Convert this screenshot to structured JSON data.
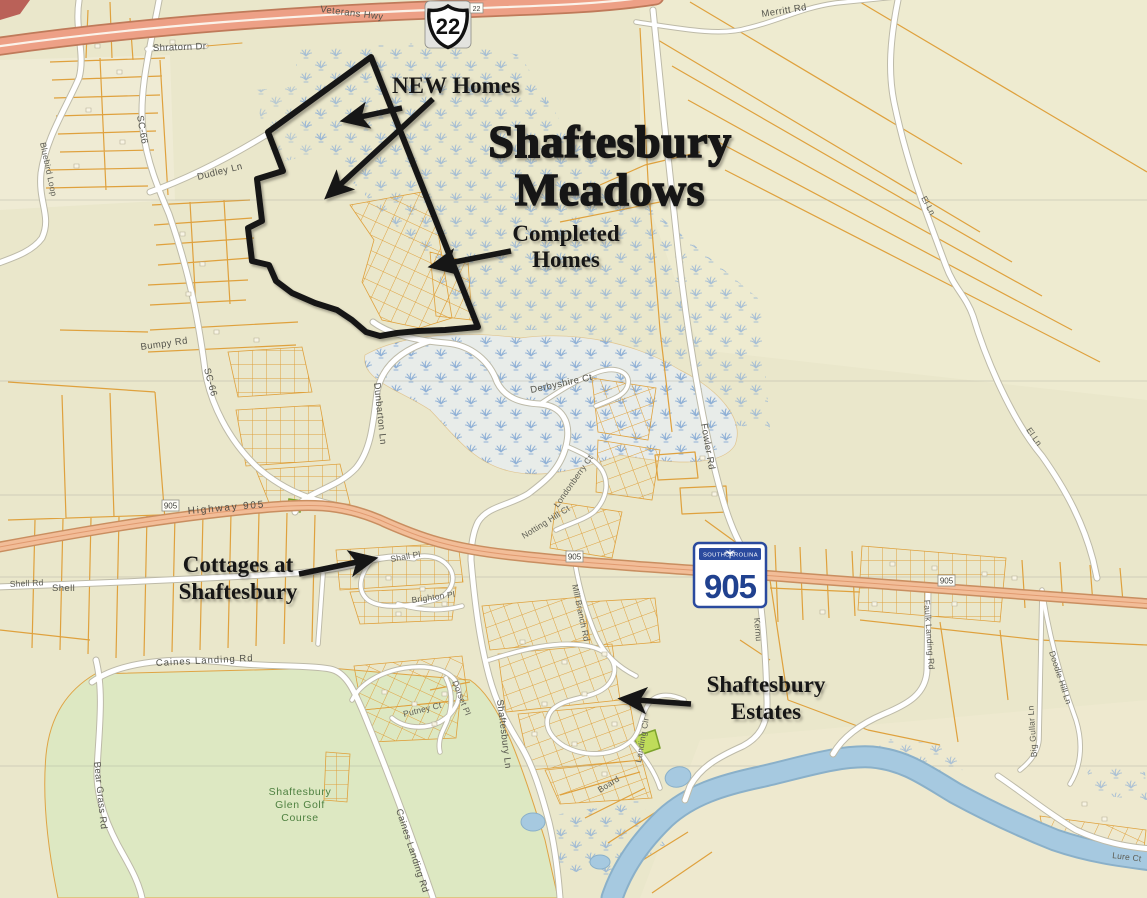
{
  "map": {
    "title": {
      "line1": "Shaftesbury",
      "line2": "Meadows"
    },
    "annotations": {
      "new_homes": {
        "label": "NEW Homes"
      },
      "completed_homes": {
        "line1": "Completed",
        "line2": "Homes"
      },
      "cottages": {
        "line1": "Cottages at",
        "line2": "Shaftesbury"
      },
      "estates": {
        "line1": "Shaftesbury",
        "line2": "Estates"
      }
    },
    "shields": {
      "us22": "22",
      "sc905": "905",
      "state_left": "SOUTH",
      "state_right": "CAROLINA"
    },
    "golf_course": {
      "line1": "Shaftesbury",
      "line2": "Glen Golf",
      "line3": "Course"
    },
    "road_labels": [
      {
        "text": "Veterans Hwy"
      },
      {
        "text": "Merritt Rd"
      },
      {
        "text": "Shratorn Dr"
      },
      {
        "text": "SC-66"
      },
      {
        "text": "SC-66"
      },
      {
        "text": "Bluebird Loop"
      },
      {
        "text": "Dudley Ln"
      },
      {
        "text": "Bumpy Rd"
      },
      {
        "text": "Dunbarton Ln"
      },
      {
        "text": "Derbyshire Ct"
      },
      {
        "text": "Londonberry Ct"
      },
      {
        "text": "Notting Hill Ct"
      },
      {
        "text": "Highway 905"
      },
      {
        "text": "Shell Rd"
      },
      {
        "text": "Shell"
      },
      {
        "text": "Mill Branch Rd"
      },
      {
        "text": "Shall Pl"
      },
      {
        "text": "Brighton Pl"
      },
      {
        "text": "Putney Ct"
      },
      {
        "text": "Dorset Pl"
      },
      {
        "text": "Caines Landing Rd"
      },
      {
        "text": "Caines Landing Rd"
      },
      {
        "text": "Bear Grass Rd"
      },
      {
        "text": "Fowler Rd"
      },
      {
        "text": "Kernu"
      },
      {
        "text": "Landing Cir"
      },
      {
        "text": "Board"
      },
      {
        "text": "Shaftesbury Ln"
      },
      {
        "text": "Faulk Landing Rd"
      },
      {
        "text": "Doodle Hill Ln"
      },
      {
        "text": "Big Gullar Ln"
      },
      {
        "text": "El Ln"
      },
      {
        "text": "El Ln"
      },
      {
        "text": "Lure Ct"
      }
    ],
    "colors": {
      "base": "#eae7cb",
      "highway_salmon": "#eda086",
      "route_905_fill": "#f2bd98",
      "minor_road": "#ffffff",
      "parcel_line": "#dfa13d",
      "river": "#a6c9e0",
      "golf_green": "#dde9c2",
      "wetland_tuft": "#8fb0d6",
      "annotation_black": "#141414",
      "shield_blue": "#2a4a9e",
      "highlight_parcel": "#b7d946"
    }
  }
}
